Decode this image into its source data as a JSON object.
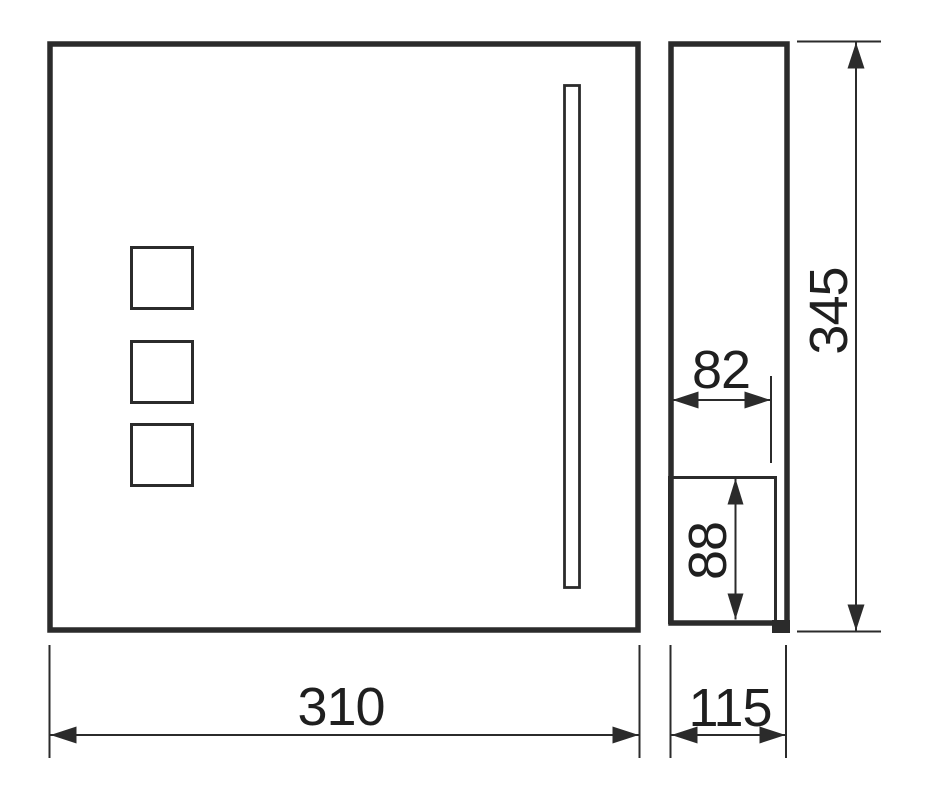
{
  "diagram": {
    "type": "technical-dimension-drawing",
    "dimensions": {
      "front_width": "310",
      "side_depth": "115",
      "overall_height": "345",
      "upper_inner_width": "82",
      "flap_height": "88"
    },
    "colors": {
      "line": "#2b2b2b",
      "label": "#1f1f1f",
      "background": "#ffffff"
    }
  }
}
